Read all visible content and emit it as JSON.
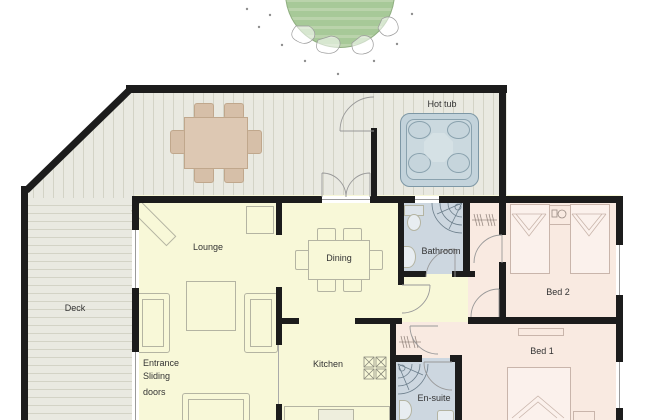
{
  "rooms": {
    "deck": {
      "label": "Deck"
    },
    "hot_tub": {
      "label": "Hot tub"
    },
    "lounge": {
      "label": "Lounge"
    },
    "dining": {
      "label": "Dining"
    },
    "kitchen": {
      "label": "Kitchen"
    },
    "bathroom": {
      "label": "Bathroom"
    },
    "bed2": {
      "label": "Bed 2"
    },
    "bed1": {
      "label": "Bed 1"
    },
    "ensuite": {
      "label": "En-suite"
    },
    "entrance": {
      "line1": "Entrance",
      "line2": "Sliding",
      "line3": "doors"
    }
  },
  "colors": {
    "wall": "#1c1c1c",
    "living": "#f8f8d8",
    "bedroom": "#f9eae1",
    "bathroom_fill": "#cdd7e0",
    "deck": "#e9e9e1",
    "deck_line": "#d3d3c6",
    "hot_tub_fill": "#c3d3db",
    "hot_tub_line": "#7d97a5",
    "tree": "#a7c998",
    "tree_stripe": "#bad3ab",
    "outdoor_table": "#ddc8b3",
    "outdoor_chair": "#d6bfa8",
    "furniture_outline": "#b4b4a2",
    "door_arc": "#999999",
    "text": "#333333"
  }
}
